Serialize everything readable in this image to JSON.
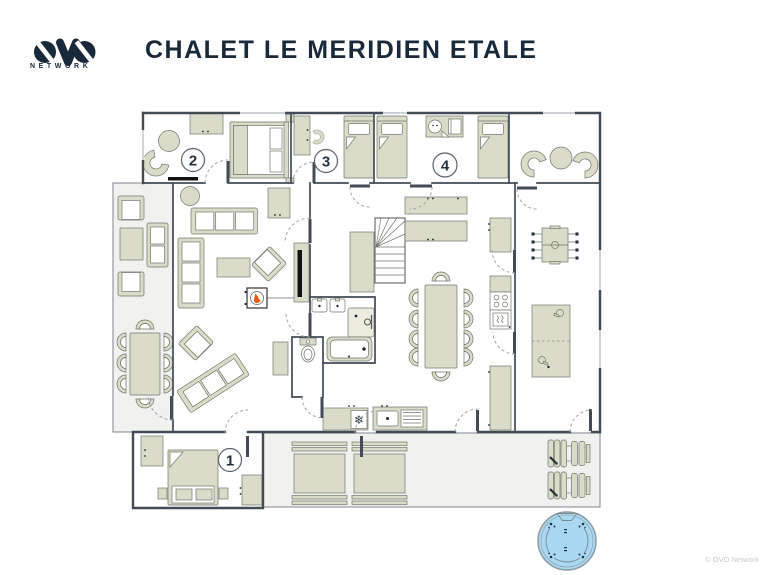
{
  "brand": {
    "logo_text": "OVO",
    "network_label": "NETWORK"
  },
  "header": {
    "title": "CHALET LE MERIDIEN ETALE"
  },
  "floorplan": {
    "rooms": [
      {
        "id": "bedroom-1",
        "number": "1"
      },
      {
        "id": "bedroom-2",
        "number": "2"
      },
      {
        "id": "bedroom-3",
        "number": "3"
      },
      {
        "id": "bedroom-4",
        "number": "4"
      }
    ],
    "icons": {
      "snowflake": "❄",
      "flame": "flame-icon",
      "baby": "baby-cot-icon",
      "shower": "shower-icon",
      "toilet": "toilet-icon",
      "bathtub": "bathtub-icon",
      "hot_tub": "hot-tub-icon",
      "foosball": "foosball-table-icon",
      "table_tennis": "table-tennis-icon",
      "staircase": "staircase-icon"
    },
    "colors": {
      "wall": "#414c57",
      "furniture": "#dadcc9",
      "terrace": "#f1f1ef",
      "flame_accent": "#e8590c",
      "hot_tub_water": "#a8d8f2",
      "brand_navy": "#17293a"
    }
  },
  "footer": {
    "copyright": "© OVO Network"
  }
}
